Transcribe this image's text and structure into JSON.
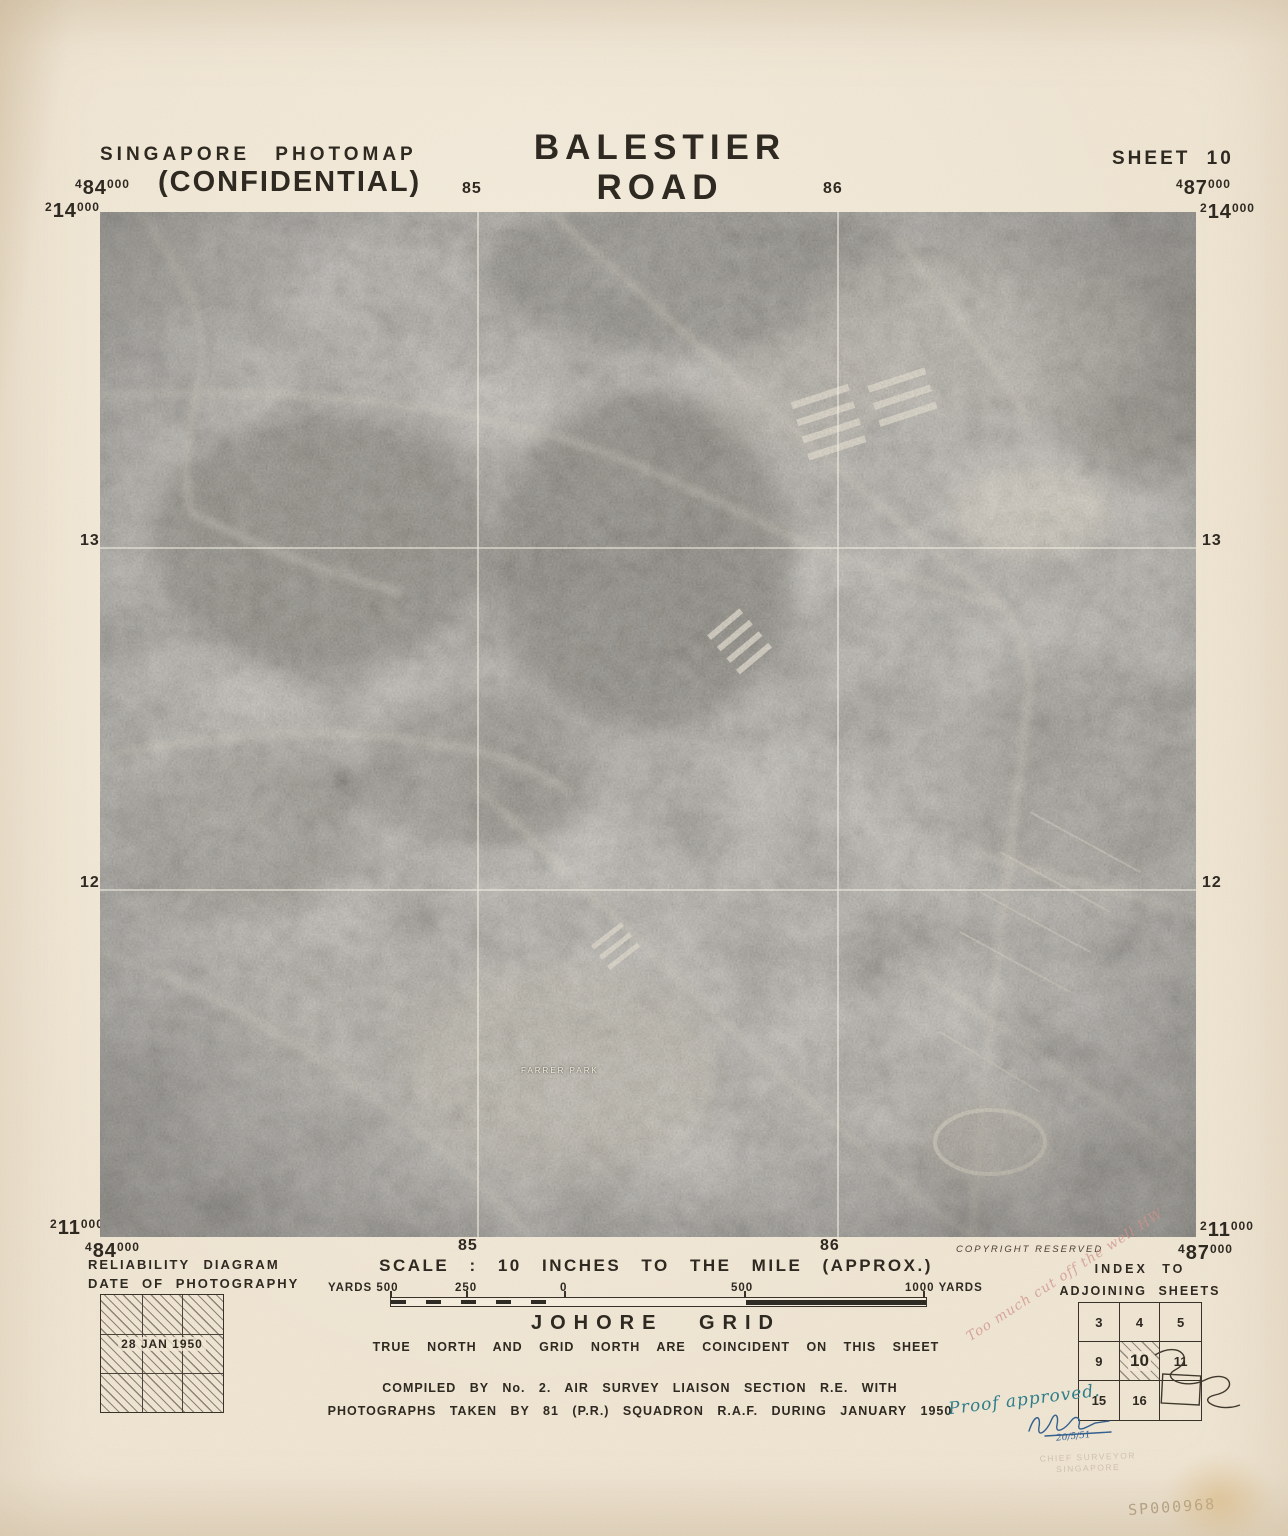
{
  "header": {
    "series": "SINGAPORE PHOTOMAP",
    "classification": "(CONFIDENTIAL)",
    "title": "BALESTIER ROAD",
    "sheet": "SHEET 10"
  },
  "grid": {
    "top_left_easting": {
      "p": "4",
      "m": "84",
      "s": "000"
    },
    "top_left_northing": {
      "p": "2",
      "m": "14",
      "s": "000"
    },
    "top_right_easting": {
      "p": "4",
      "m": "87",
      "s": "000"
    },
    "top_right_northing": {
      "p": "2",
      "m": "14",
      "s": "000"
    },
    "bottom_left_northing": {
      "p": "2",
      "m": "11",
      "s": "000"
    },
    "bottom_left_easting": {
      "p": "4",
      "m": "84",
      "s": "000"
    },
    "bottom_right_northing": {
      "p": "2",
      "m": "11",
      "s": "000"
    },
    "bottom_right_easting": {
      "p": "4",
      "m": "87",
      "s": "000"
    },
    "top_labels": [
      "85",
      "86"
    ],
    "bottom_labels": [
      "85",
      "86"
    ],
    "left_labels": [
      "13",
      "12"
    ],
    "right_labels": [
      "13",
      "12"
    ]
  },
  "photo": {
    "place_label": "FARRER PARK",
    "copyright": "COPYRIGHT RESERVED"
  },
  "scale_bar": {
    "title": "SCALE : 10 INCHES TO THE MILE (APPROX.)",
    "left_label": "YARDS 500",
    "tick_250": "250",
    "tick_0": "0",
    "tick_500": "500",
    "right_label": "1000 YARDS"
  },
  "grid_note": {
    "title": "JOHORE GRID",
    "subtitle": "TRUE NORTH AND GRID NORTH ARE COINCIDENT ON THIS SHEET"
  },
  "compilation": {
    "line1": "COMPILED BY No. 2. AIR SURVEY LIAISON SECTION R.E. WITH",
    "line2": "PHOTOGRAPHS TAKEN BY 81 (P.R.) SQUADRON R.A.F. DURING JANUARY 1950"
  },
  "reliability": {
    "title1": "RELIABILITY DIAGRAM",
    "title2": "DATE OF PHOTOGRAPHY",
    "date": "28 JAN 1950"
  },
  "index": {
    "title1": "INDEX TO",
    "title2": "ADJOINING SHEETS",
    "cells": [
      "3",
      "4",
      "5",
      "9",
      "10",
      "11",
      "15",
      "16",
      ""
    ],
    "current_sheet": "10"
  },
  "annotations": {
    "pencil_note": "Too much cut off the well  HW",
    "proof_note": "Proof approved.",
    "signature_date": "20/5/51",
    "stamp_line1": "CHIEF SURVEYOR",
    "stamp_line2": "SINGAPORE",
    "archive_code": "SP000968"
  },
  "colors": {
    "paper": "#f1e6d3",
    "ink": "#2e2921",
    "photo_gray": "#8d8b83",
    "annotation_pink": "#ce948a",
    "annotation_teal": "#2f7e8a",
    "annotation_ink_blue": "#33608e",
    "pencil": "#b2a183"
  }
}
